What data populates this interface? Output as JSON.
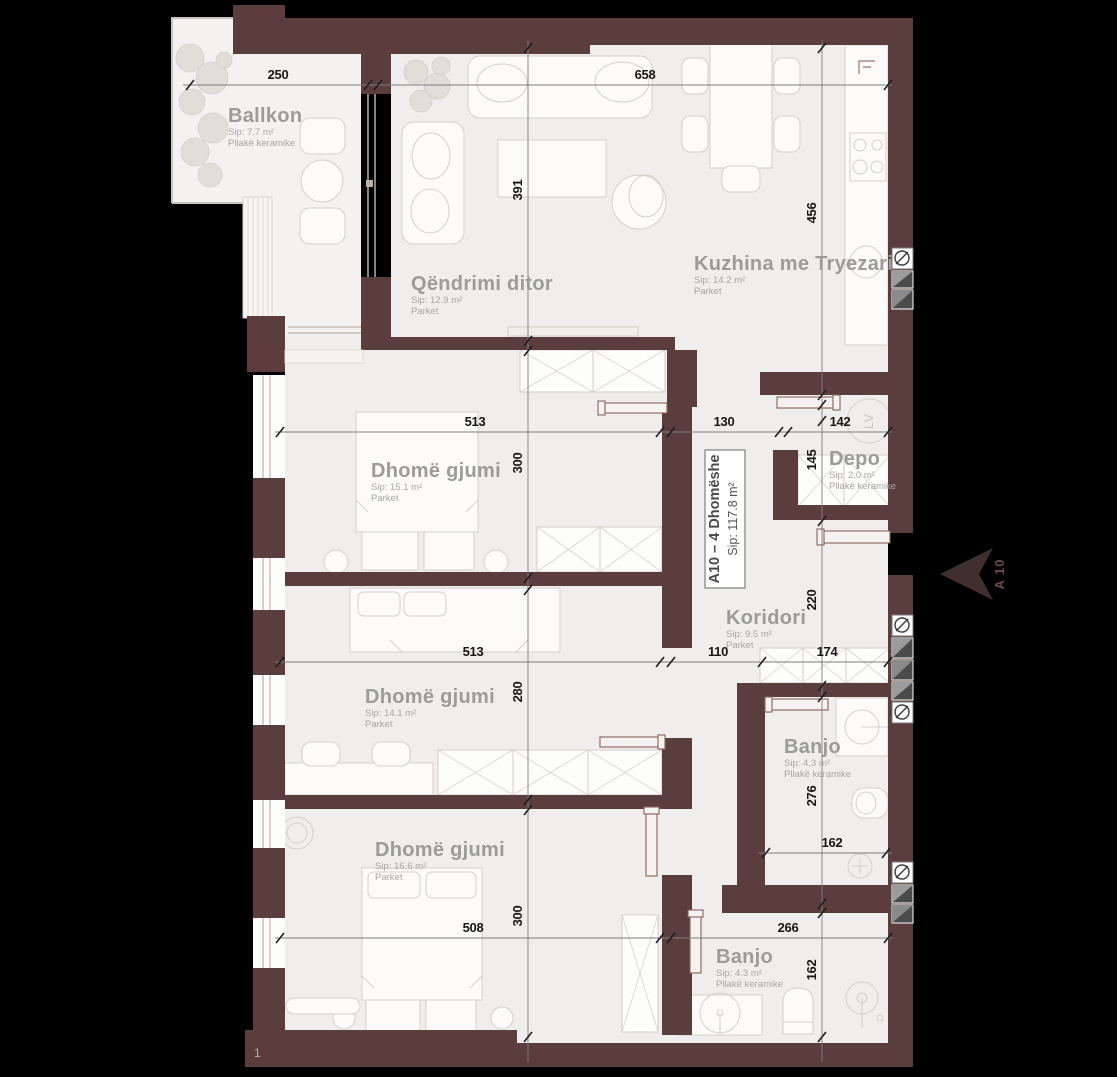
{
  "plan": {
    "title": "Apartment floor plan A10",
    "unit": {
      "title": "A10 – 4 Dhomëshe",
      "area": "Sip: 117.8 m²"
    },
    "marker": {
      "label": "A 10"
    },
    "grid": {
      "label": "1"
    },
    "appliances": {
      "washer": "LV"
    },
    "rooms": {
      "ballkon": {
        "name": "Ballkon",
        "area": "Sip: 7.7 m²",
        "floor": "Pllakë keramike"
      },
      "living": {
        "name": "Qëndrimi ditor",
        "area": "Sip: 12.9 m²",
        "floor": "Parket"
      },
      "kitchen": {
        "name": "Kuzhina me Tryezari",
        "area": "Sip: 14.2 m²",
        "floor": "Parket"
      },
      "bedroom1": {
        "name": "Dhomë gjumi",
        "area": "Sip: 15.1 m²",
        "floor": "Parket"
      },
      "depo": {
        "name": "Depo",
        "area": "Sip: 2.0 m²",
        "floor": "Pllakë keramike"
      },
      "corridor": {
        "name": "Koridori",
        "area": "Sip: 9.5 m²",
        "floor": "Parket"
      },
      "bedroom2": {
        "name": "Dhomë gjumi",
        "area": "Sip: 14.1 m²",
        "floor": "Parket"
      },
      "bath1": {
        "name": "Banjo",
        "area": "Sip: 4.3 m²",
        "floor": "Pllakë keramike"
      },
      "bedroom3": {
        "name": "Dhomë gjumi",
        "area": "Sip: 16.6 m²",
        "floor": "Parket"
      },
      "bath2": {
        "name": "Banjo",
        "area": "Sip: 4.3 m²",
        "floor": "Pllakë keramike"
      }
    },
    "dims": {
      "h250": "250",
      "h658": "658",
      "v391": "391",
      "v456": "456",
      "h513a": "513",
      "h130": "130",
      "h142": "142",
      "v145": "145",
      "v300a": "300",
      "v220": "220",
      "h513b": "513",
      "h110": "110",
      "h174": "174",
      "v280": "280",
      "v276": "276",
      "h162a": "162",
      "h508": "508",
      "h266": "266",
      "v162b": "162",
      "v300b": "300"
    },
    "colors": {
      "background": "#000000",
      "wall": "#5b3d3d",
      "floor": "#efeeec",
      "label": "#9b9b9b",
      "dimension": "#161616"
    }
  }
}
